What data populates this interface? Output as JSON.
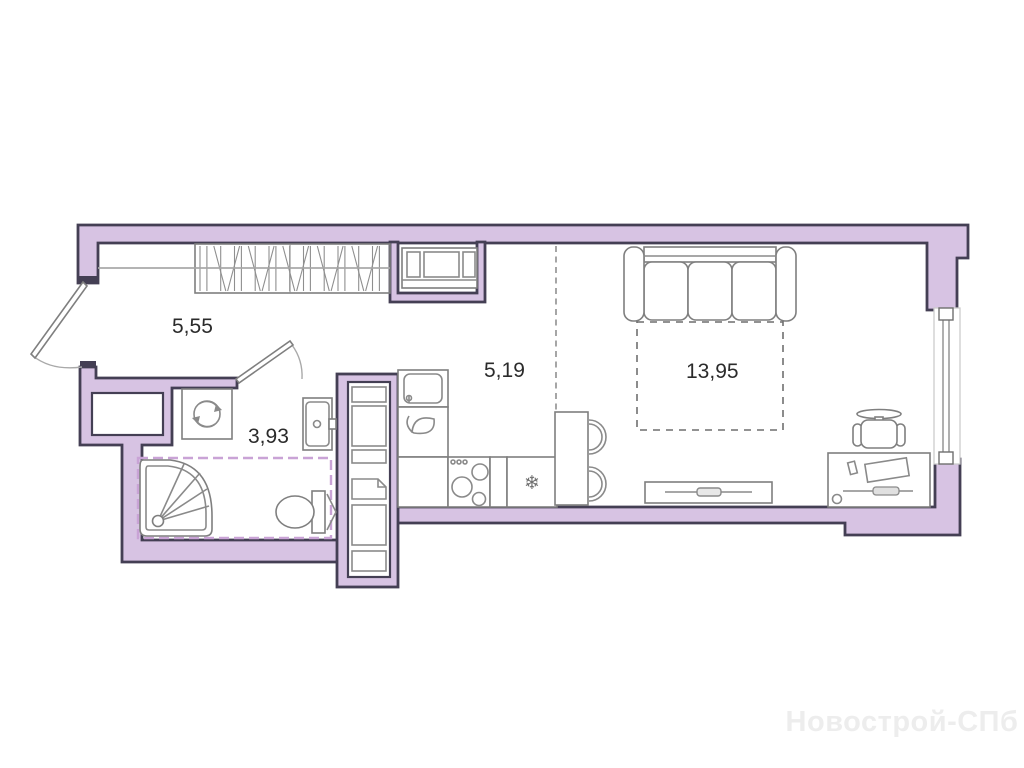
{
  "watermark": {
    "text": "Новострой-СПб"
  },
  "rooms": {
    "hallway": {
      "area": "5,55"
    },
    "bathroom": {
      "area": "3,93"
    },
    "kitchen": {
      "area": "5,19"
    },
    "living": {
      "area": "13,95"
    }
  },
  "glyphs": {
    "fridge_snowflake": "❄"
  },
  "colors": {
    "wall_fill": "#d7c3e3",
    "wall_outline": "#443f54",
    "furniture_line": "#7f7f7f",
    "wet_zone_dash": "#c9a3d6",
    "label_text": "#2b2b2b",
    "watermark_text": "#ededed"
  },
  "furniture_legend": [
    "wardrobe",
    "shelf-niche",
    "sofa",
    "bed-zone",
    "tv-stand",
    "desk",
    "office-chair",
    "bar-counter",
    "bar-stools",
    "fridge",
    "stove",
    "kitchen-sink",
    "kitchen-counter",
    "tall-cabinet",
    "washing-machine",
    "bathroom-sink",
    "toilet",
    "shower",
    "entrance-door",
    "bathroom-door",
    "window"
  ]
}
